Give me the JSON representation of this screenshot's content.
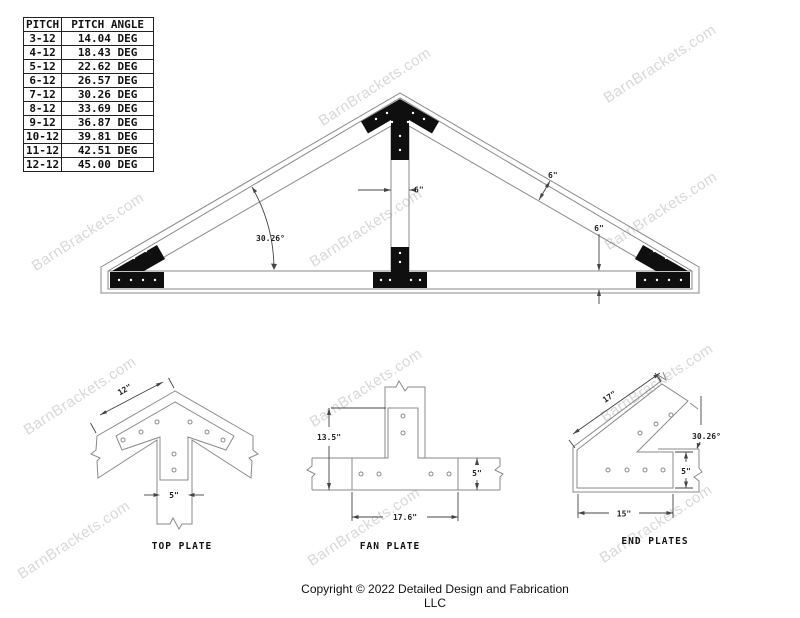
{
  "watermark": {
    "text": "BarnBrackets.com",
    "color": "#d8d8d8"
  },
  "pitch_table": {
    "headers": [
      "PITCH",
      "PITCH ANGLE"
    ],
    "rows": [
      [
        "3-12",
        "14.04 DEG"
      ],
      [
        "4-12",
        "18.43 DEG"
      ],
      [
        "5-12",
        "22.62 DEG"
      ],
      [
        "6-12",
        "26.57 DEG"
      ],
      [
        "7-12",
        "30.26 DEG"
      ],
      [
        "8-12",
        "33.69 DEG"
      ],
      [
        "9-12",
        "36.87 DEG"
      ],
      [
        "10-12",
        "39.81 DEG"
      ],
      [
        "11-12",
        "42.51 DEG"
      ],
      [
        "12-12",
        "45.00 DEG"
      ]
    ]
  },
  "truss": {
    "post_width": "6\"",
    "rafter_depth": "6\"",
    "chord_depth": "6\"",
    "pitch_angle": "30.26°"
  },
  "top_plate": {
    "label": "TOP PLATE",
    "dim_edge": "12\"",
    "dim_stem": "5\""
  },
  "fan_plate": {
    "label": "FAN PLATE",
    "dim_height": "13.5\"",
    "dim_depth": "5\"",
    "dim_width": "17.6\""
  },
  "end_plates": {
    "label": "END PLATES",
    "dim_edge": "17\"",
    "dim_angle": "30.26°",
    "dim_depth": "5\"",
    "dim_width": "15\""
  },
  "footer": {
    "copyright": "Copyright © 2022 Detailed Design and Fabrication LLC"
  }
}
